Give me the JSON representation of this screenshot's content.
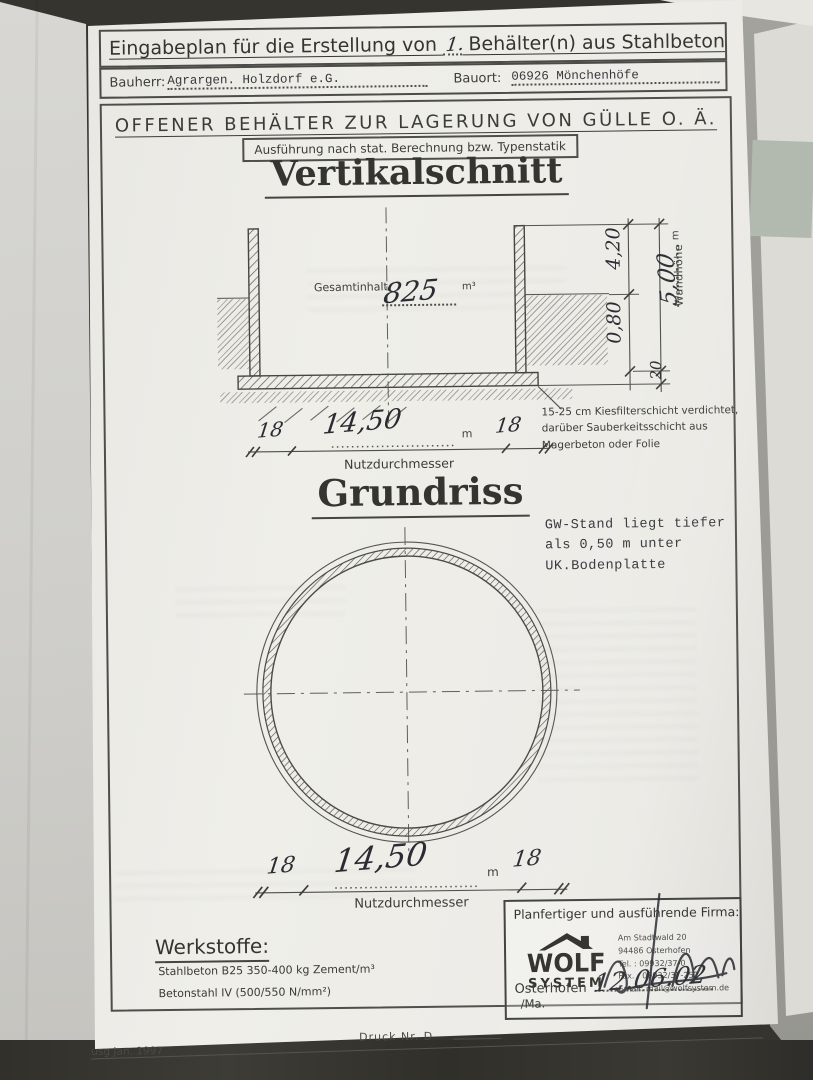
{
  "colors": {
    "desk": "#35342f",
    "paper": "#edece7",
    "ink": "#3e3e3a",
    "hand_ink": "#2b2c33"
  },
  "header": {
    "title_prefix": "Eingabeplan für die Erstellung von ",
    "title_count": "1.",
    "title_suffix": " Behälter(n) aus Stahlbeton",
    "bauherr_label": "Bauherr:",
    "bauherr_value": "Agrargen. Holzdorf e.G.",
    "bauort_label": "Bauort:",
    "bauort_value": "06926 Mönchenhöfe"
  },
  "banner": {
    "subtitle": "OFFENER BEHÄLTER ZUR LAGERUNG VON GÜLLE O. Ä.",
    "spec_note": "Ausführung nach stat. Berechnung bzw. Typenstatik"
  },
  "vertical_section": {
    "heading": "Vertikalschnitt",
    "content_label": "Gesamtinhalt",
    "content_value": "825",
    "content_unit": "m³",
    "dim_upper": "4,20",
    "dim_lower": "0,80",
    "wall_height_value": "5,00",
    "wall_height_unit": "m",
    "wall_height_label": "Wandhöhe",
    "slab_thickness": "20",
    "foundation_note_line1": "15-25 cm Kiesfilterschicht verdichtet,",
    "foundation_note_line2": "darüber Sauberkeitsschicht aus",
    "foundation_note_line3": "Magerbeton oder Folie",
    "dim": {
      "left_wall": "18",
      "value": "14,50",
      "unit": "m",
      "right_wall": "18",
      "label": "Nutzdurchmesser"
    }
  },
  "plan_view": {
    "heading": "Grundriss",
    "gw_note_line1": "GW-Stand liegt tiefer",
    "gw_note_line2": "als 0,50 m unter",
    "gw_note_line3": "UK.Bodenplatte",
    "dim": {
      "left_wall": "18",
      "value": "14,50",
      "unit": "m",
      "right_wall": "18",
      "label": "Nutzdurchmesser"
    }
  },
  "materials": {
    "heading": "Werkstoffe:",
    "line1": "Stahlbeton B25 350-400 kg Zement/m³",
    "line2": "Betonstahl IV (500/550 N/mm²)"
  },
  "firm": {
    "heading": "Planfertiger und ausführende Firma:",
    "logo_word": "WOLF",
    "logo_sub": "SYSTEM",
    "address_line1": "Am Stadtwald 20",
    "address_line2": "94486 Osterhofen",
    "address_line3": "Tel. : 09932/37-0",
    "address_line4": "Fax. : 09932/37-252",
    "address_line5": "Email: mail@wolfsystem.de",
    "place": "Osterhofen",
    "date": "12.06.02",
    "initials": "/Ma."
  },
  "footer": {
    "left": "usg Jan. 1997",
    "center": "Druck Nr. D"
  }
}
